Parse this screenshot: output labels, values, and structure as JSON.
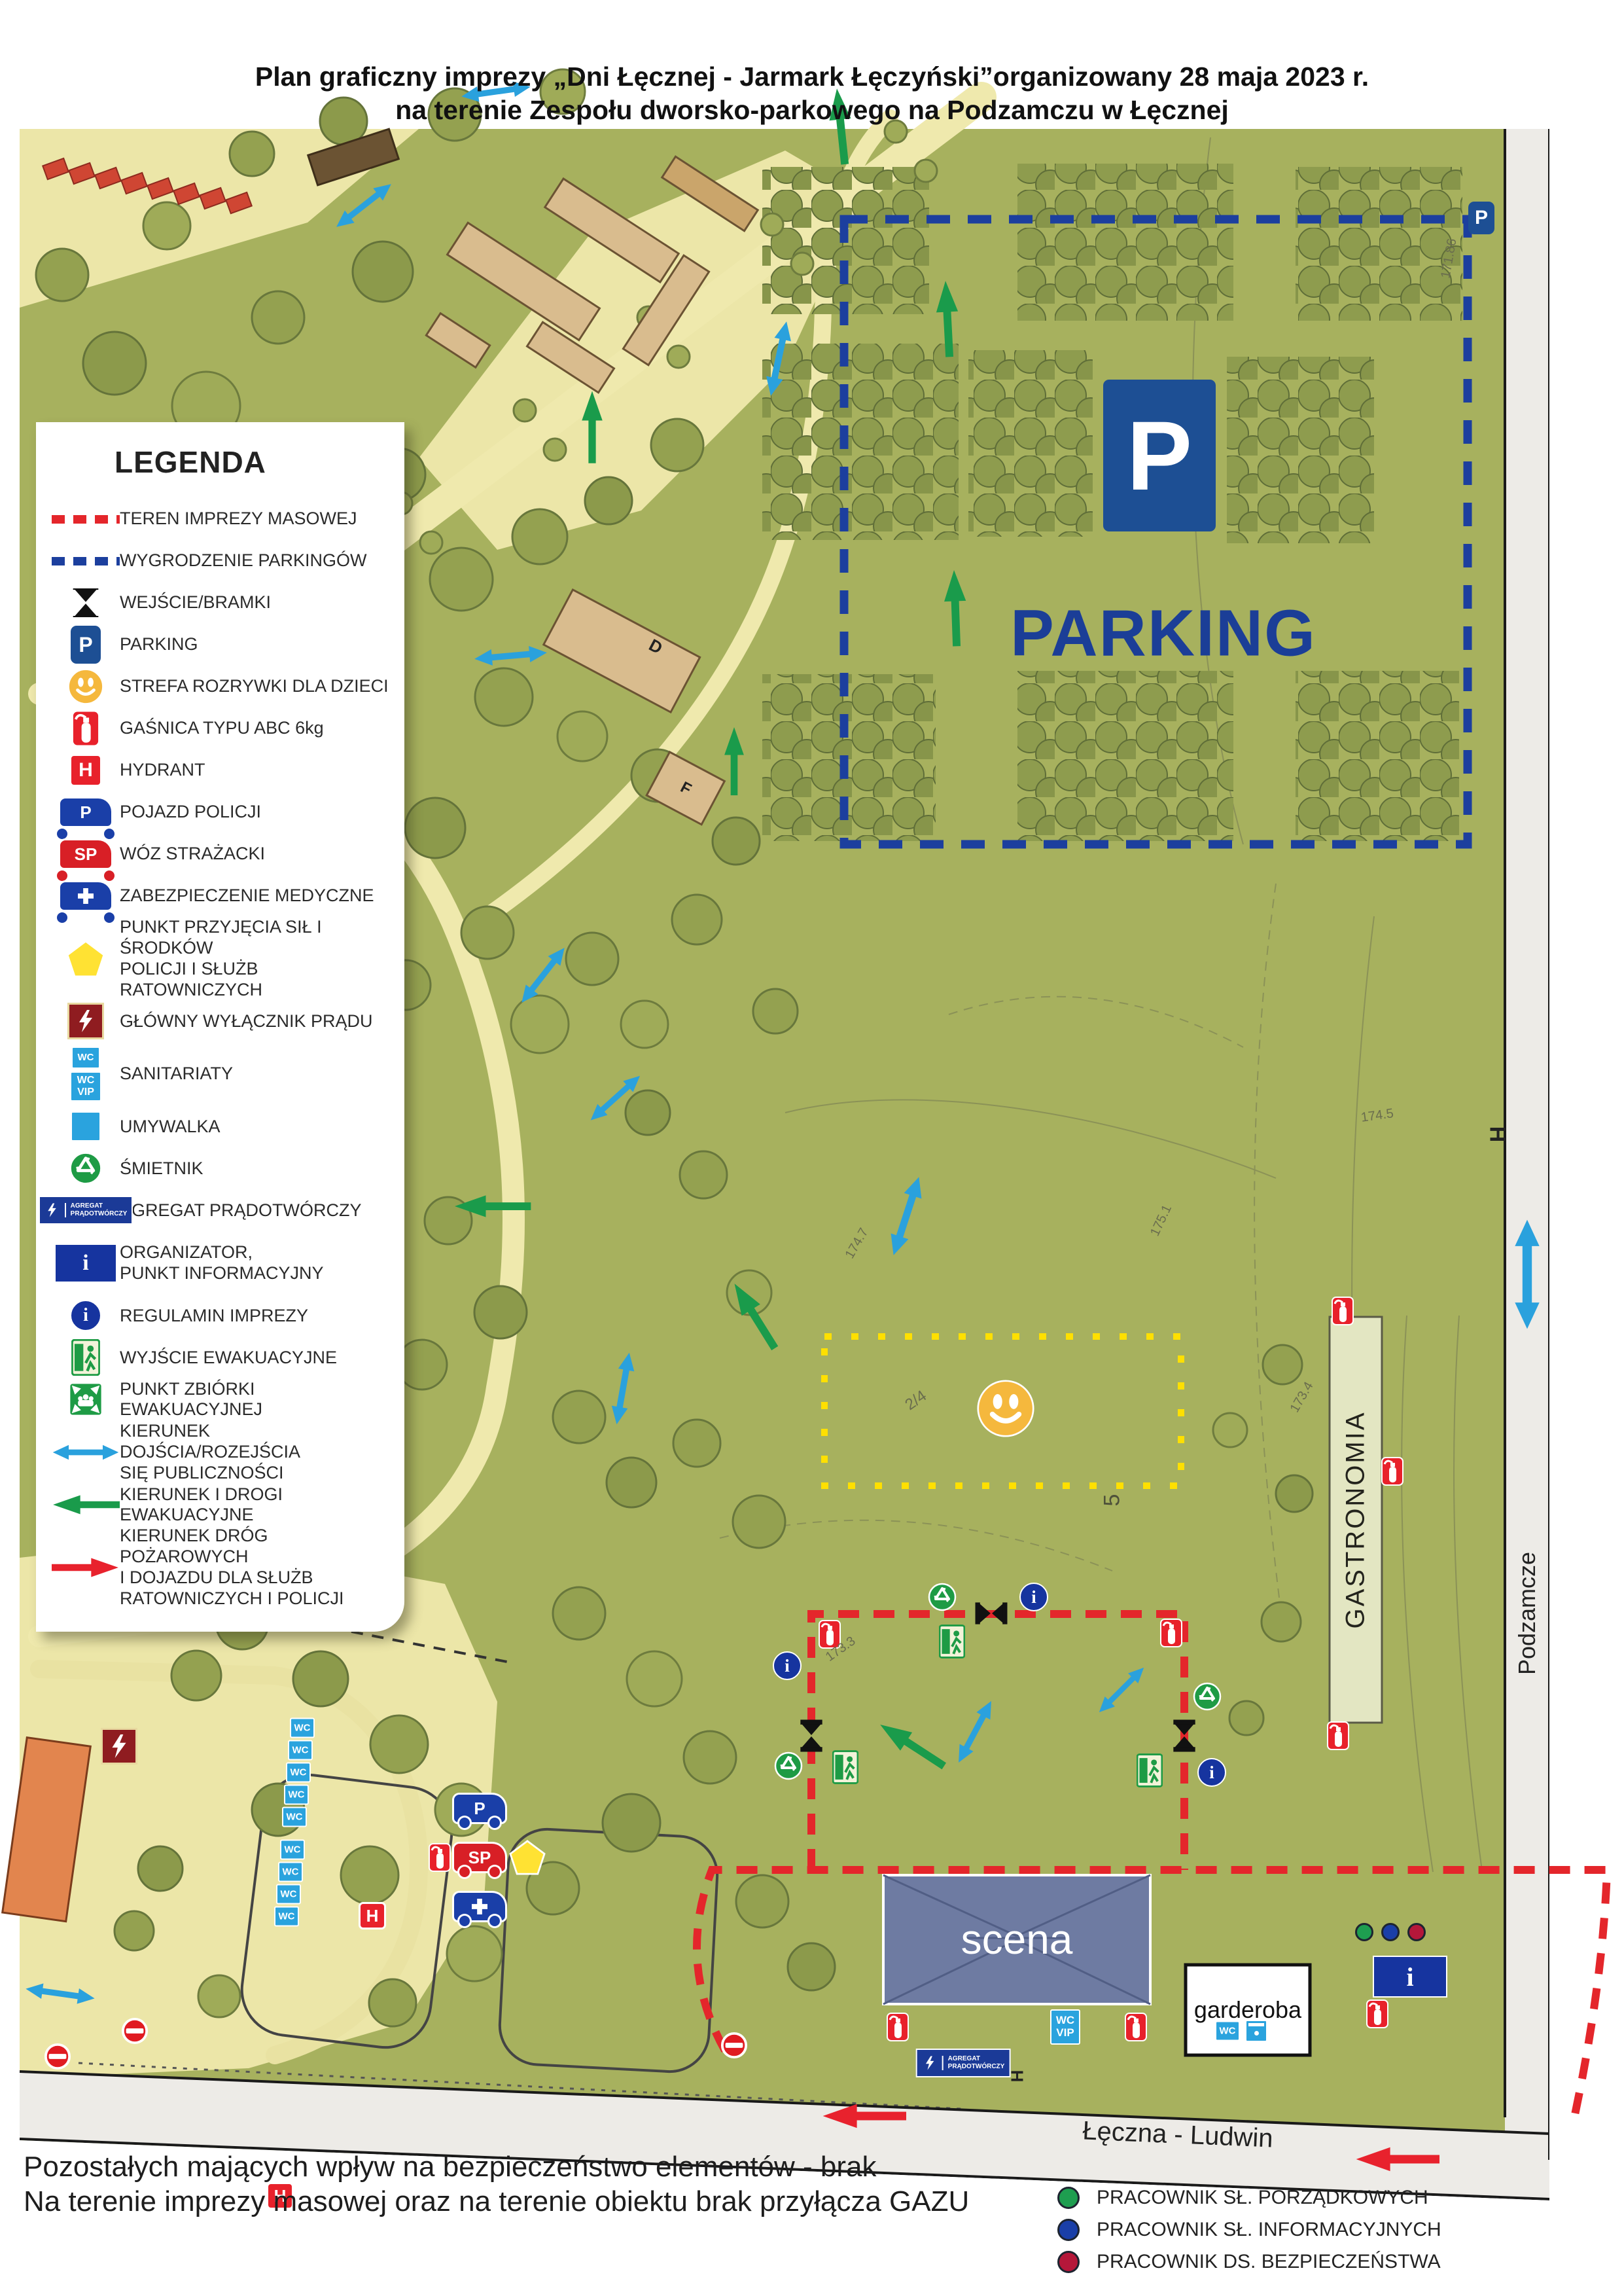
{
  "title": {
    "line1": "Plan graficzny imprezy „Dni Łęcznej - Jarmark Łęczyński”organizowany 28 maja 2023 r.",
    "line2": "na terenie Zespołu dworsko-parkowego na Podzamczu w Łęcznej"
  },
  "legend": {
    "title": "LEGENDA",
    "items": [
      {
        "label": "TEREN IMPREZY MASOWEJ"
      },
      {
        "label": "WYGRODZENIE PARKINGÓW"
      },
      {
        "label": "WEJŚCIE/BRAMKI"
      },
      {
        "label": "PARKING"
      },
      {
        "label": "STREFA ROZRYWKI DLA DZIECI"
      },
      {
        "label": "GAŚNICA TYPU ABC 6kg"
      },
      {
        "label": "HYDRANT"
      },
      {
        "label": "POJAZD POLICJI"
      },
      {
        "label": "WÓZ STRAŻACKI"
      },
      {
        "label": "ZABEZPIECZENIE MEDYCZNE"
      },
      {
        "label": "PUNKT PRZYJĘCIA SIŁ I ŚRODKÓW\nPOLICJI I SŁUŻB RATOWNICZYCH"
      },
      {
        "label": "GŁÓWNY WYŁĄCZNIK PRĄDU"
      },
      {
        "label": "SANITARIATY"
      },
      {
        "label": "UMYWALKA"
      },
      {
        "label": "ŚMIETNIK"
      },
      {
        "label": "AGREGAT PRĄDOTWÓRCZY"
      },
      {
        "label": "ORGANIZATOR,\nPUNKT INFORMACYJNY"
      },
      {
        "label": "REGULAMIN IMPREZY"
      },
      {
        "label": "WYJŚCIE EWAKUACYJNE"
      },
      {
        "label": "PUNKT ZBIÓRKI EWAKUACYJNEJ"
      },
      {
        "label": "KIERUNEK DOJŚCIA/ROZEJŚCIA\nSIĘ PUBLICZNOŚCI"
      },
      {
        "label": "KIERUNEK I DROGI EWAKUACYJNE"
      },
      {
        "label": "KIERUNEK DRÓG POŻAROWYCH\nI DOJAZDU DLA SŁUŻB\nRATOWNICZYCH I POLICJI"
      }
    ]
  },
  "icon_labels": {
    "p": "P",
    "sp": "SP",
    "h": "H",
    "wc": "WC",
    "vip": "VIP",
    "i": "i",
    "agregat_line1": "AGREGAT",
    "agregat_line2": "PRĄDOTWÓRCZY"
  },
  "map": {
    "parking_label": "PARKING",
    "scena": "scena",
    "garderoba": "garderoba",
    "gastronomia": "GASTRONOMIA",
    "streets": {
      "right": "Podzamcze",
      "bottom": "Łęczna - Ludwin"
    },
    "building_labels": {
      "d": "D",
      "f": "F"
    },
    "parcel_labels": [
      "2/4",
      "5",
      "174.7",
      "175.1",
      "174.5",
      "173.4",
      "171.86",
      "173.3"
    ],
    "h_marker": "H"
  },
  "footer": {
    "line1": "Pozostałych mających wpływ na bezpieczeństwo elementów - brak",
    "line2": "Na terenie imprezy masowej oraz na terenie obiektu brak przyłącza GAZU"
  },
  "staff_legend": [
    {
      "label": "PRACOWNIK SŁ. PORZĄDKOWYCH",
      "color": "#1e9e50"
    },
    {
      "label": "PRACOWNIK SŁ. INFORMACYJNYCH",
      "color": "#1a3fa8"
    },
    {
      "label": "PRACOWNIK DS. BEZPIECZEŃSTWA",
      "color": "#b5173a"
    }
  ],
  "colors": {
    "map_green": "#a7b15e",
    "event_boundary_red": "#e4262b",
    "parking_boundary_blue": "#1c3f9e",
    "public_arrow_blue": "#2aa1dd",
    "evac_arrow_green": "#1a9b4b",
    "fire_arrow_red": "#e8222d",
    "children_zone_yellow": "#ffe000"
  }
}
